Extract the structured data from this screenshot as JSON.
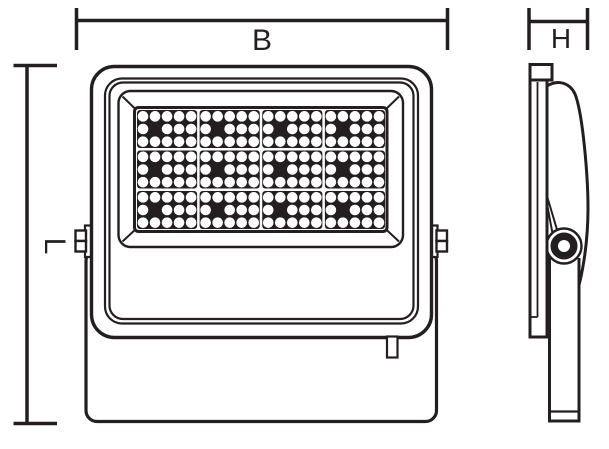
{
  "figure": {
    "dimension_labels": {
      "width": "B",
      "height": "L",
      "depth": "H"
    },
    "colors": {
      "line": "#231f20",
      "background": "#ffffff",
      "led_module_fill": "#231f20",
      "led_fill": "#ffffff"
    },
    "led_panel": {
      "module_columns": 4,
      "module_rows": 3,
      "led_columns": 5,
      "led_rows": 3,
      "dark_led_row": 1,
      "dark_led_col": 1
    }
  }
}
